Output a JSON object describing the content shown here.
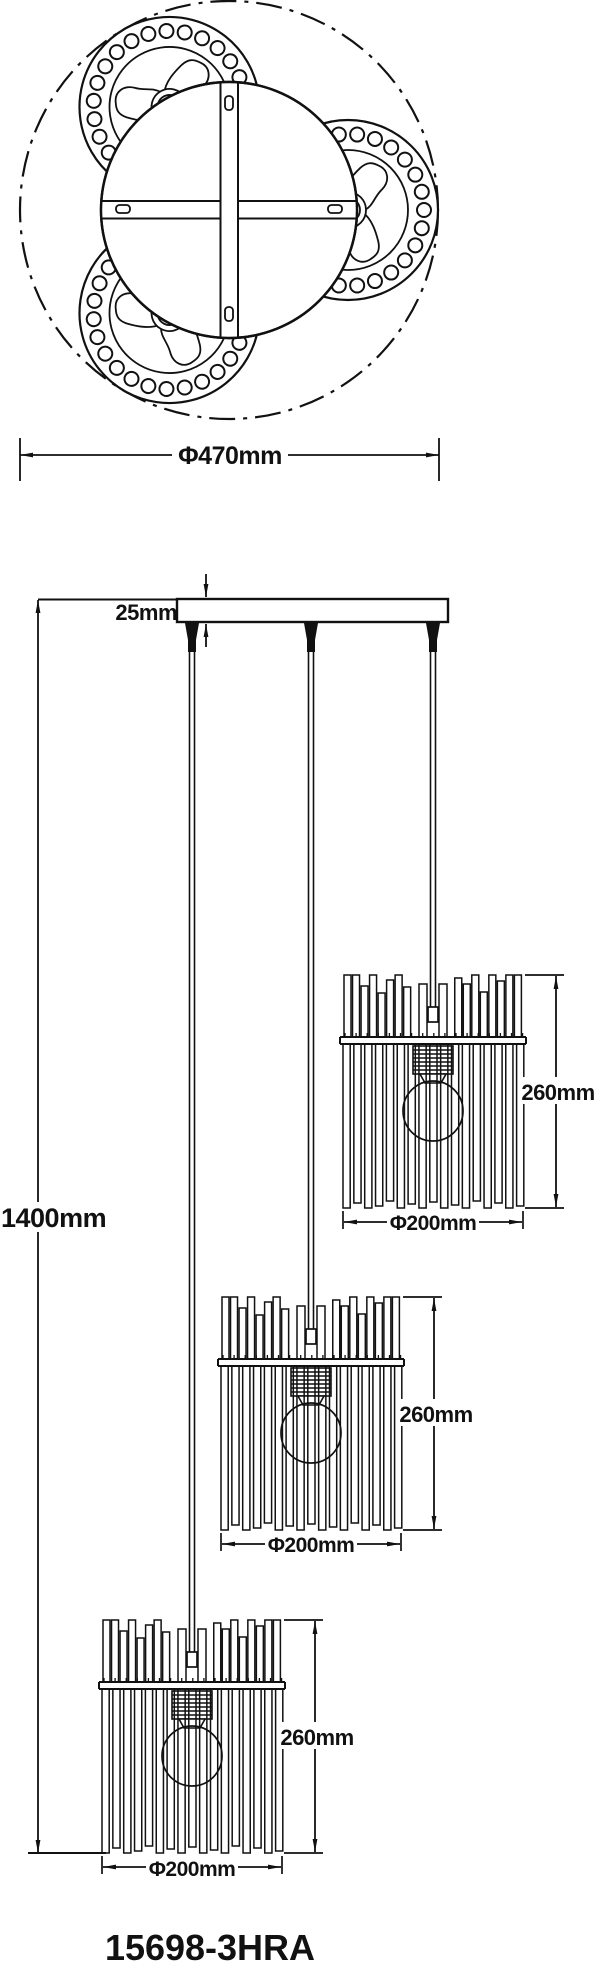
{
  "title": "Pendant lamp technical dimension drawing",
  "colors": {
    "line": "#111111",
    "background": "#ffffff"
  },
  "top_view": {
    "fixture_diameter_label": "Φ470mm"
  },
  "front_view": {
    "canopy_height_label": "25mm",
    "total_drop_label": "1400mm",
    "lamps": [
      {
        "position": "top-right",
        "height_label": "260mm",
        "diameter_label": "Φ200mm"
      },
      {
        "position": "middle",
        "height_label": "260mm",
        "diameter_label": "Φ200mm"
      },
      {
        "position": "bottom-left",
        "height_label": "260mm",
        "diameter_label": "Φ200mm"
      }
    ]
  },
  "model_number": "15698-3HRA"
}
